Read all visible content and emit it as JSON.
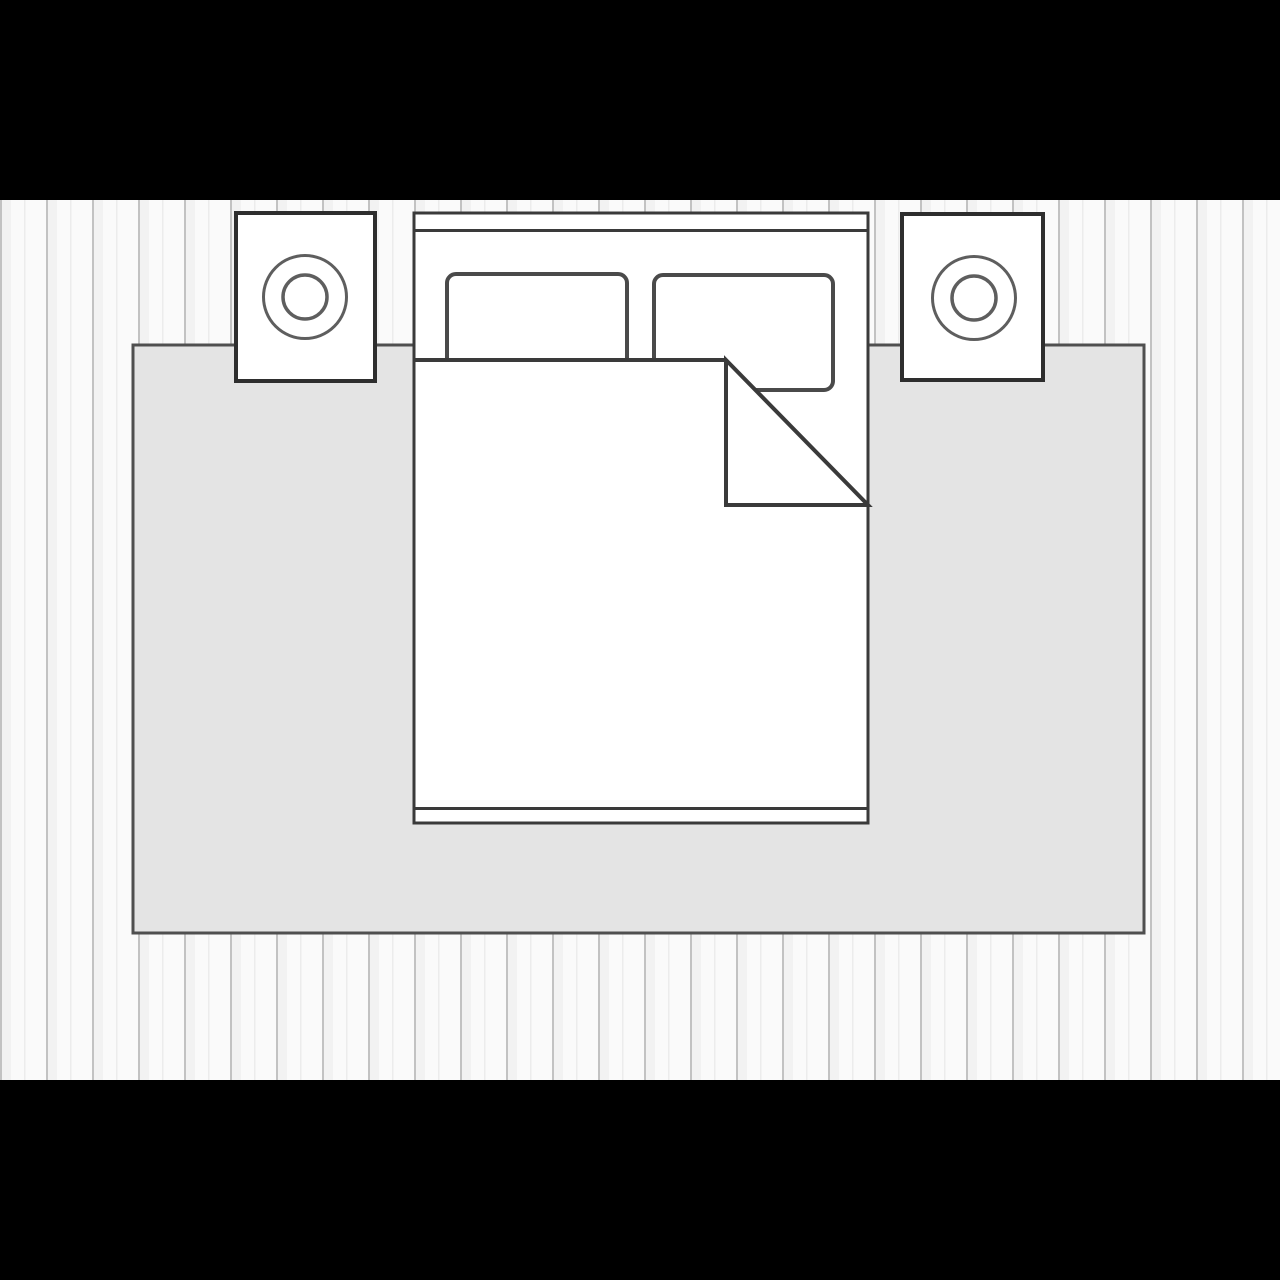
{
  "scene": {
    "type": "bedroom-floor-plan-diagram",
    "objects": [
      "plank floor",
      "area rug",
      "double bed with headboard and footboard",
      "left pillow",
      "right pillow",
      "duvet with folded-back corner",
      "left nightstand with lamp",
      "right nightstand with lamp"
    ]
  },
  "colors": {
    "letterbox": "#000000",
    "floor_base": "#fafafa",
    "plank_line": "#c2c2c2",
    "plank_shade": "#f2f2f2",
    "plank_midline": "#ececec",
    "rug_fill": "#e4e4e4",
    "rug_outline": "#4f4f4f",
    "white_fill": "#ffffff",
    "furniture_outline": "#3a3a3a",
    "pillow_outline": "#4a4a4a",
    "nightstand_outline": "#2e2e2e",
    "lamp_outline": "#5e5e5e"
  }
}
